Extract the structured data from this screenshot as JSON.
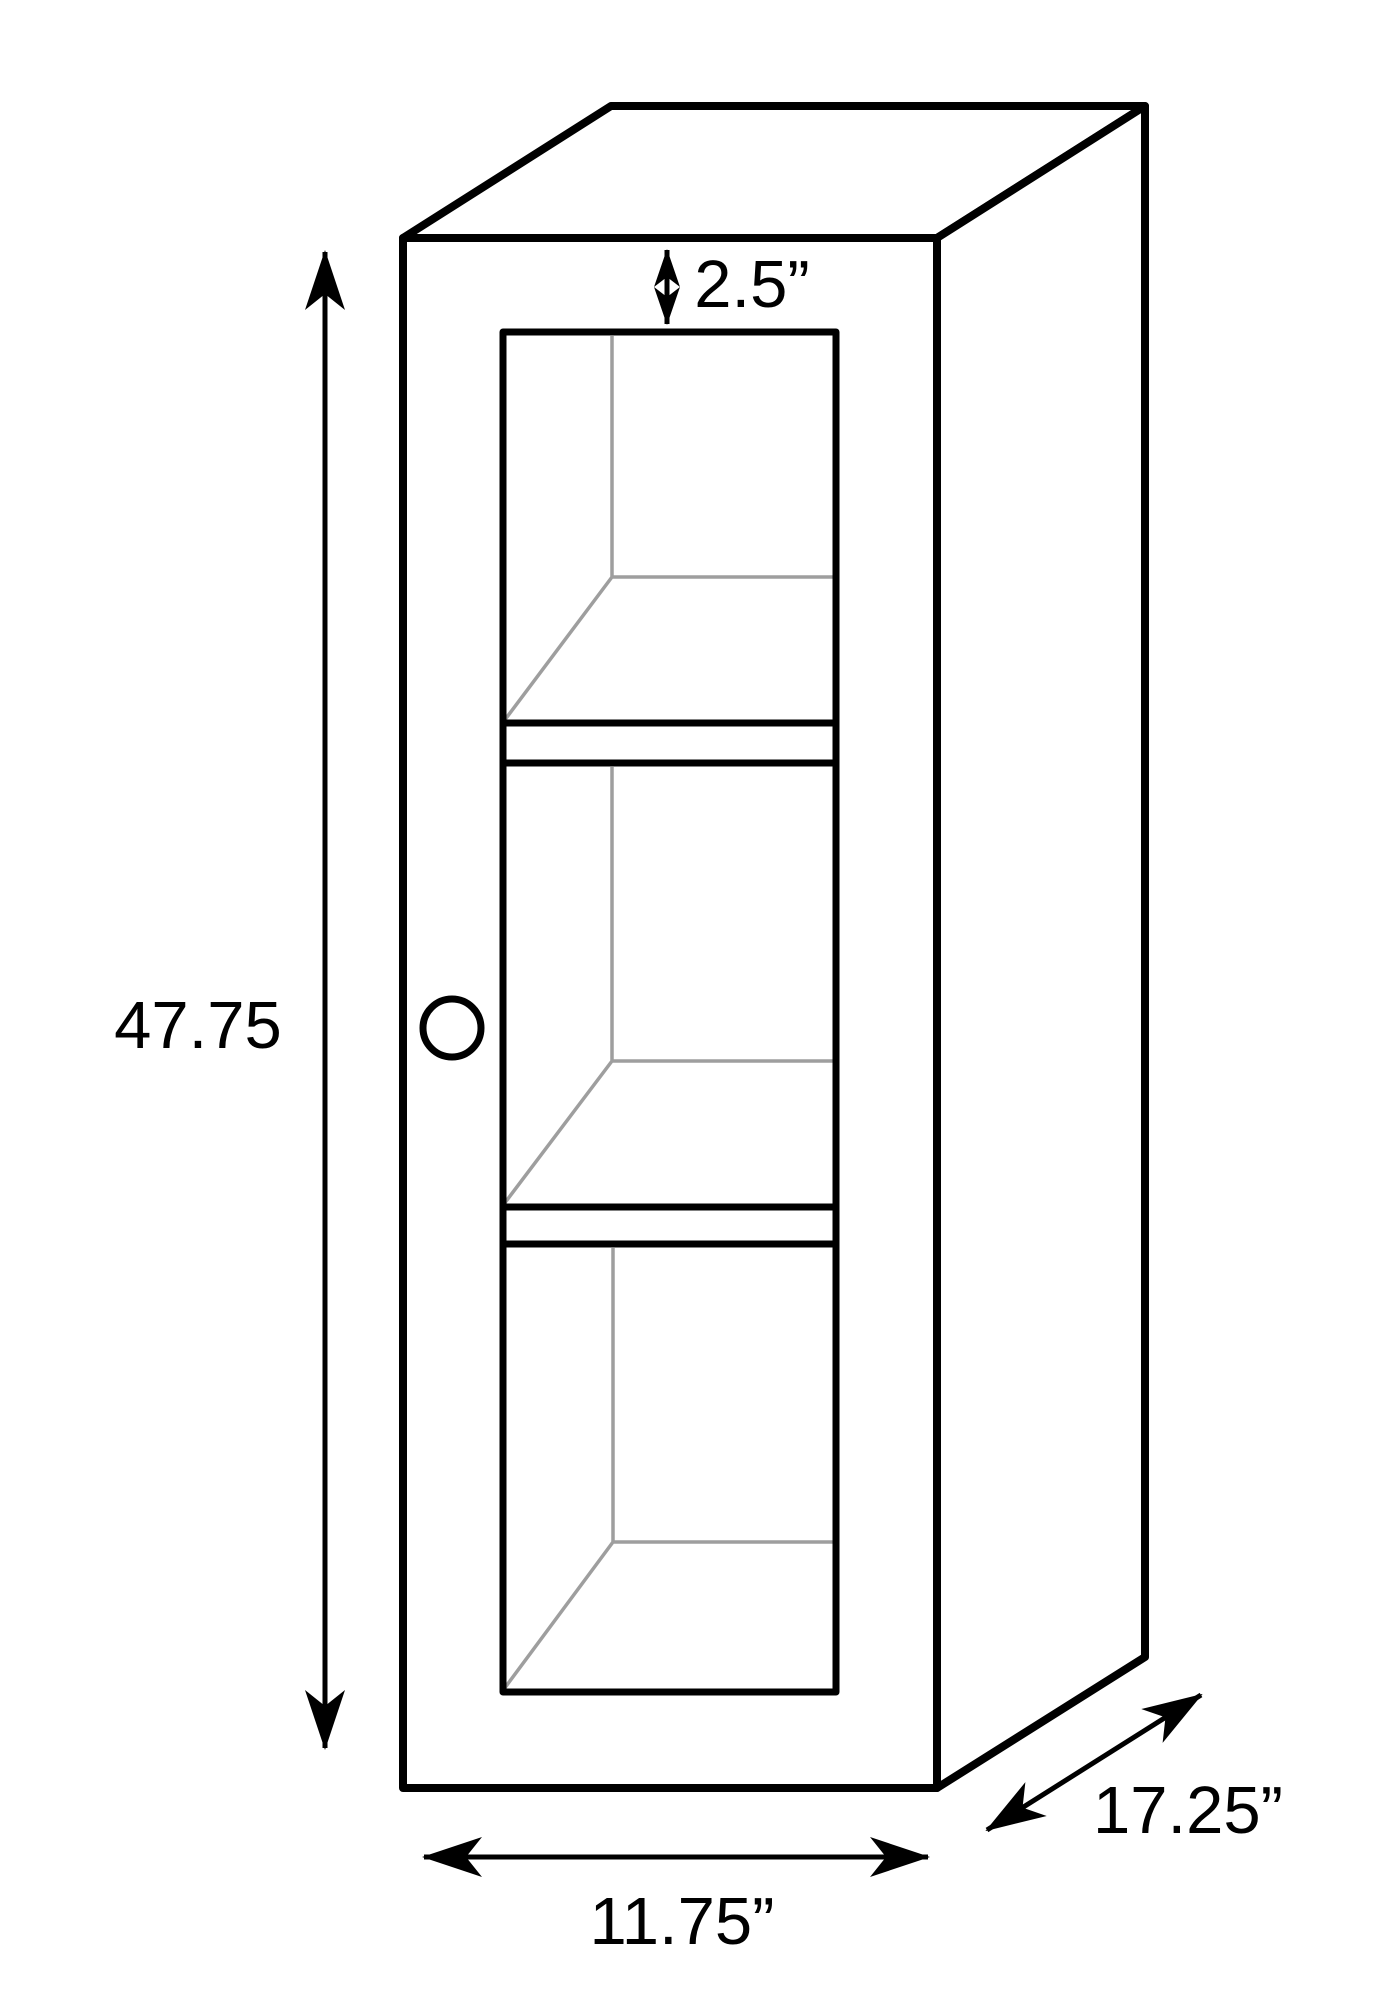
{
  "diagram": {
    "type": "furniture-dimension-line-drawing",
    "subject": "tall narrow cabinet with glass door, door knob, and two interior shelves (three compartments), drawn in oblique 3D projection",
    "labels": {
      "height": "47.75",
      "top_inset": "2.5”",
      "width": "11.75”",
      "depth": "17.25”"
    },
    "colors": {
      "outline": "#000000",
      "interior_edges": "#9e9e9e",
      "background": "#ffffff"
    }
  }
}
